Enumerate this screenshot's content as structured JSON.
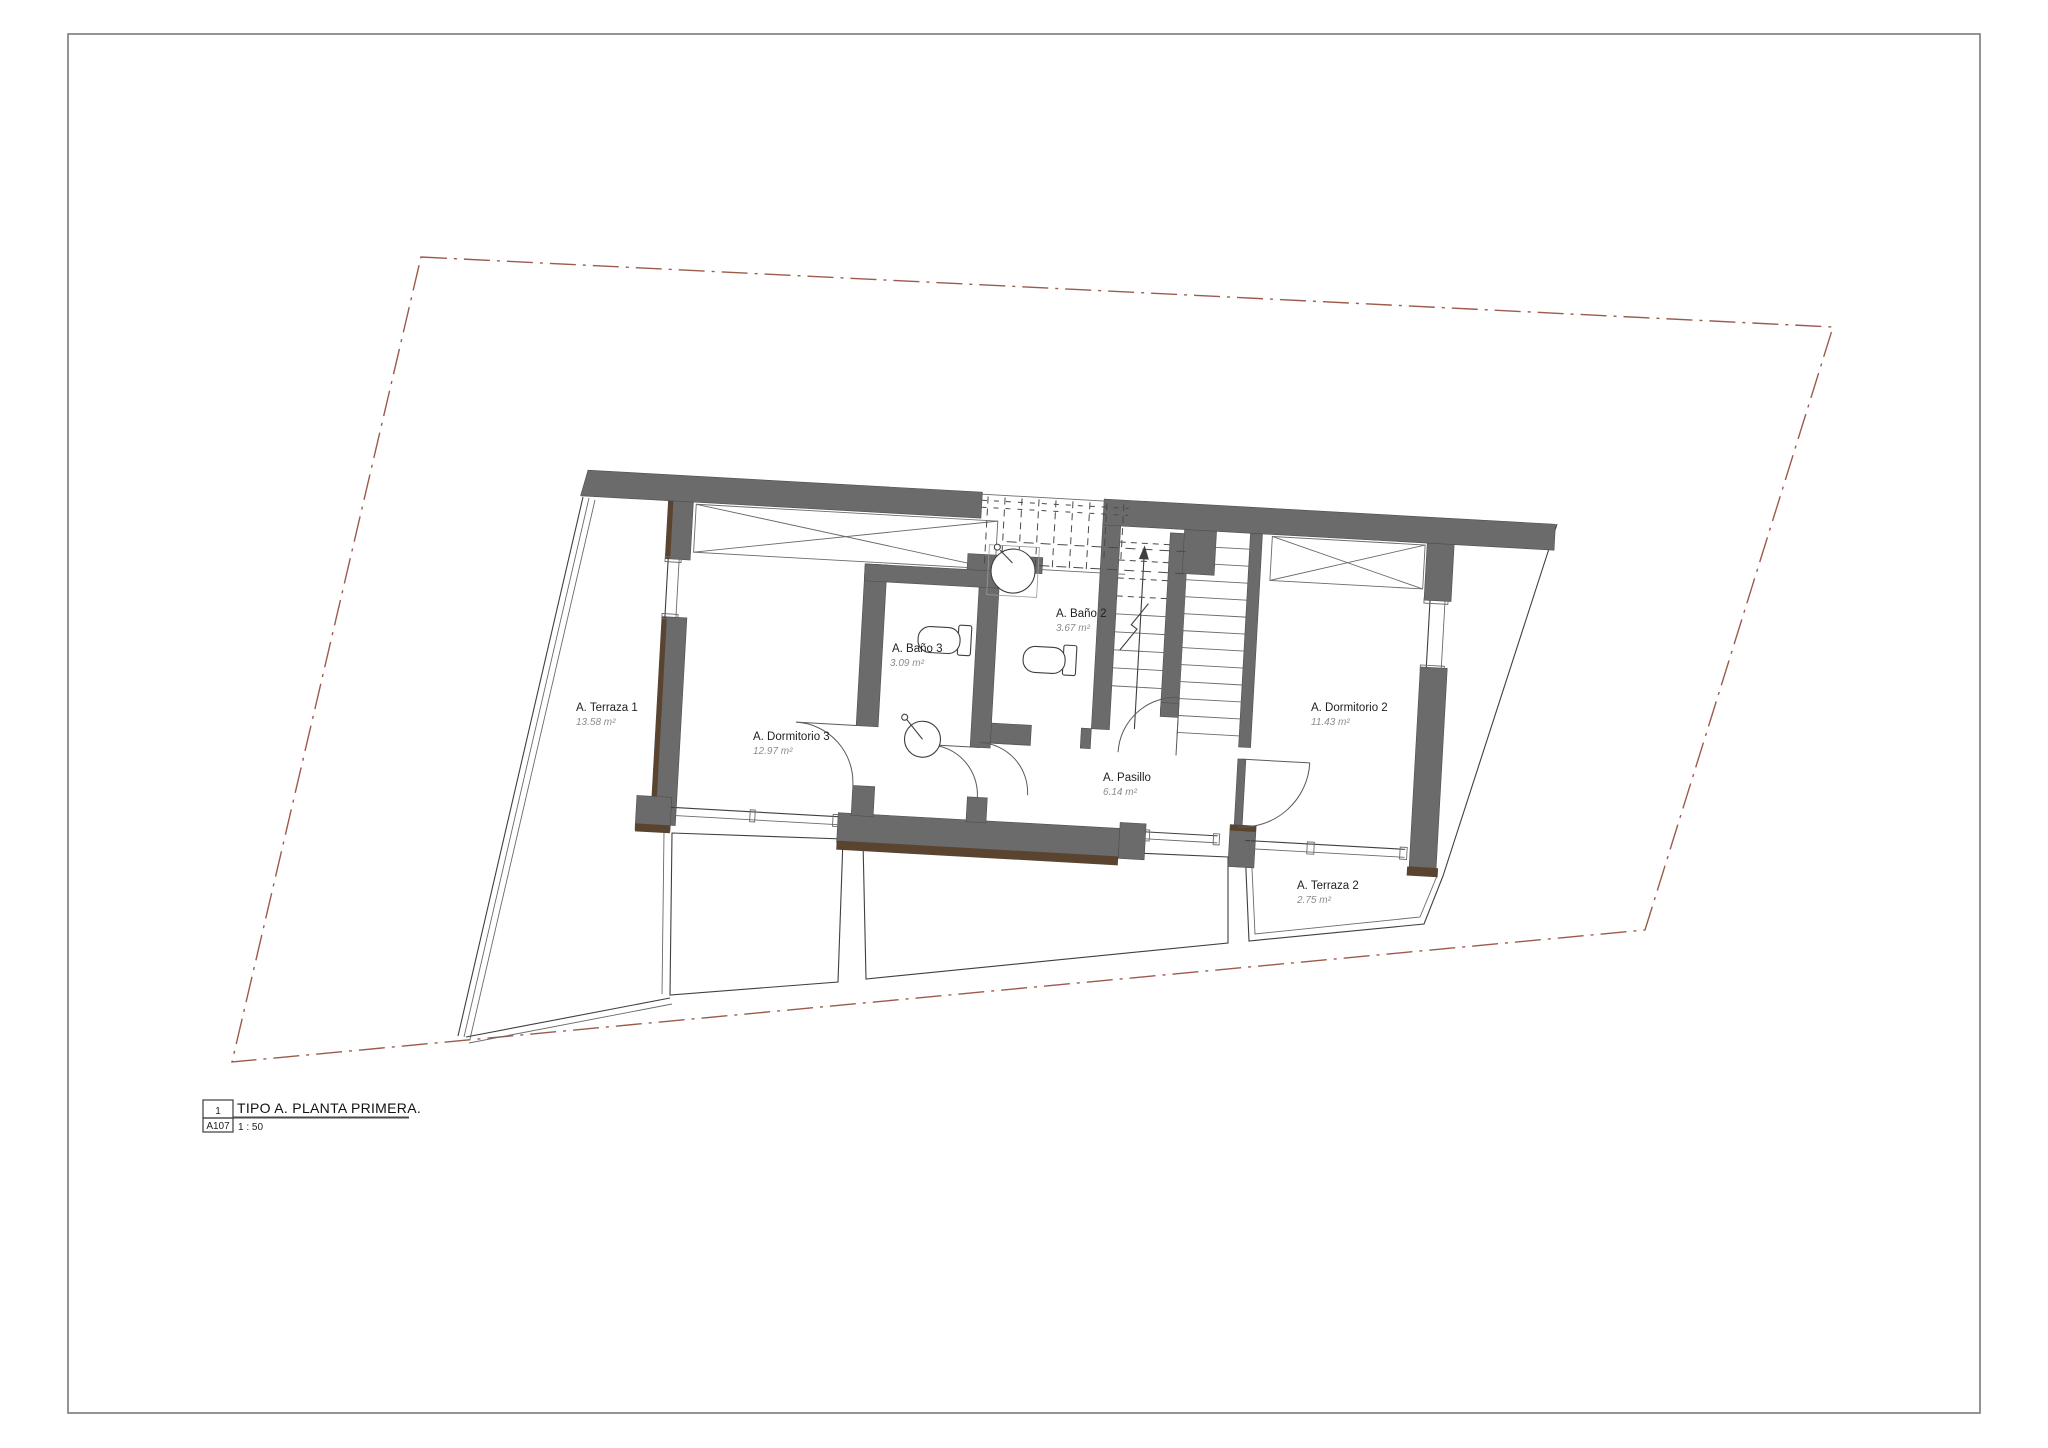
{
  "page": {
    "background": "#ffffff",
    "border_color": "#7a7a7a"
  },
  "plan": {
    "drawing_type": "floor-plan",
    "rooms": [
      {
        "id": "terraza1",
        "name": "A. Terraza 1",
        "area": "13.58 m²"
      },
      {
        "id": "dormitorio3",
        "name": "A. Dormitorio 3",
        "area": "12.97 m²"
      },
      {
        "id": "bano3",
        "name": "A. Baño 3",
        "area": "3.09 m²"
      },
      {
        "id": "bano2",
        "name": "A. Baño 2",
        "area": "3.67 m²"
      },
      {
        "id": "pasillo",
        "name": "A. Pasillo",
        "area": "6.14 m²"
      },
      {
        "id": "dormitorio2",
        "name": "A. Dormitorio 2",
        "area": "11.43 m²"
      },
      {
        "id": "terraza2",
        "name": "A. Terraza 2",
        "area": "2.75 m²"
      }
    ],
    "colors": {
      "wall": "#6b6b6b",
      "wall_accent_brown": "#5a4430",
      "site_boundary": "#9c5a4c",
      "line": "#3f3f3f",
      "room_name_text": "#1f1f1f",
      "room_area_text": "#8c8c8c"
    }
  },
  "title_block": {
    "detail_number": "1",
    "sheet_number": "A107",
    "title": "TIPO A. PLANTA PRIMERA.",
    "scale": "1 : 50"
  }
}
